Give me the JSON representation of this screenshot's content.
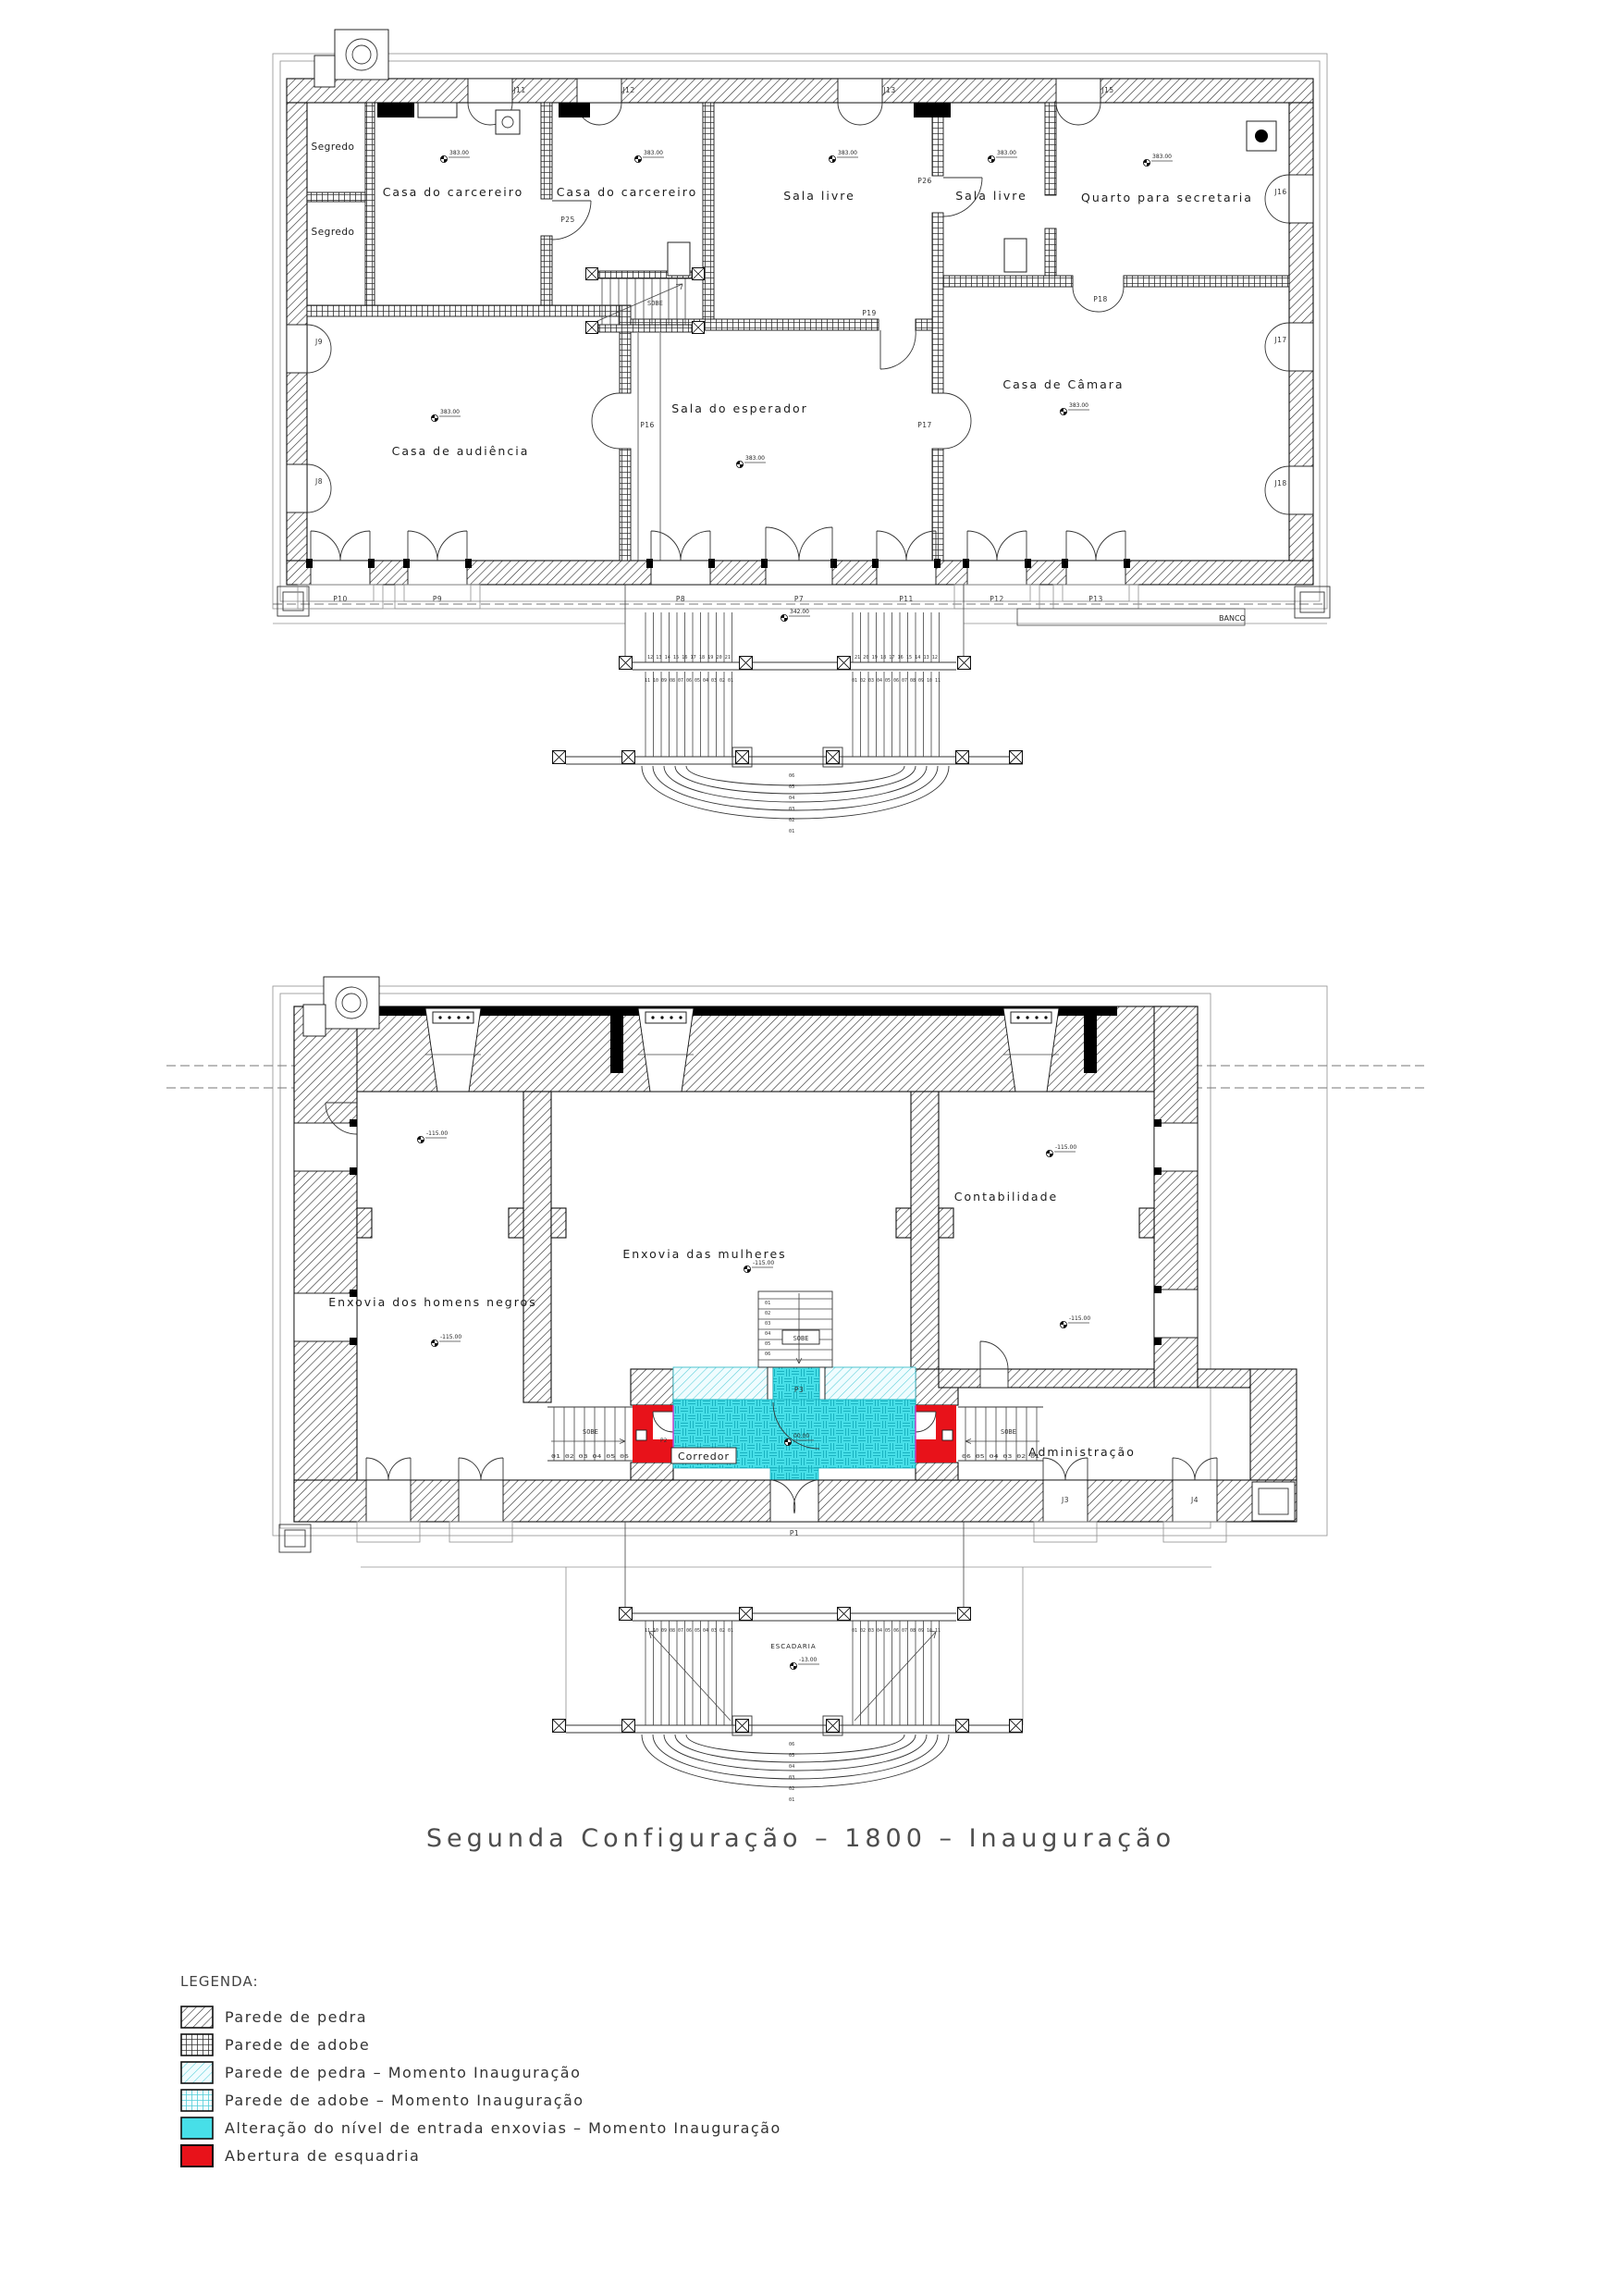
{
  "title": "Segunda Configuração – 1800 – Inauguração",
  "legend": {
    "heading": "LEGENDA:",
    "items": [
      {
        "key": "stone-hatch",
        "label": "Parede de pedra"
      },
      {
        "key": "adobe-grid",
        "label": "Parede de adobe"
      },
      {
        "key": "stone-hatch-cyan",
        "label": "Parede de pedra – Momento Inauguração"
      },
      {
        "key": "adobe-grid-cyan",
        "label": "Parede de adobe – Momento Inauguração"
      },
      {
        "key": "solid-cyan",
        "label": "Alteração do nível de entrada enxovias – Momento Inauguração"
      },
      {
        "key": "solid-red",
        "label": "Abertura de esquadria"
      }
    ]
  },
  "colors": {
    "highlight_cyan": "#47dfe8",
    "highlight_red": "#e8121a"
  },
  "plan1": {
    "rooms": {
      "segredo1": "Segredo",
      "segredo2": "Segredo",
      "carcereiro1": "Casa do carcereiro",
      "carcereiro2": "Casa do carcereiro",
      "sala_livre1": "Sala livre",
      "sala_livre2": "Sala livre",
      "quarto_secretaria": "Quarto para secretaria",
      "sala_esperador": "Sala do esperador",
      "casa_audiencia": "Casa de audiência",
      "casa_camara": "Casa de Câmara"
    },
    "doors": {
      "p7": "P7",
      "p8": "P8",
      "p9": "P9",
      "p10": "P10",
      "p11": "P11",
      "p12": "P12",
      "p13": "P13",
      "p16": "P16",
      "p17": "P17",
      "p18": "P18",
      "p19": "P19",
      "p25": "P25",
      "p26": "P26"
    },
    "windows": {
      "j8": "J8",
      "j9": "J9",
      "j11": "J11",
      "j12": "J12",
      "j13": "J13",
      "j15": "J15",
      "j16": "J16",
      "j17": "J17",
      "j18": "J18"
    },
    "labels": {
      "sobe": "SOBE",
      "banco": "BANCO"
    },
    "levels": {
      "floor": "383.00",
      "terrace": "342.00"
    },
    "stairs": {
      "left_upper": "12 13 14 15 16 17 18 19 20 21",
      "left_lower": "11 10 09 08 07 06 05 04 03 02 01",
      "right_upper": "21 20 19 18 17 16 15 14 13 12",
      "right_lower": "01 02 03 04 05 06 07 08 09 10 11",
      "curved": [
        "06",
        "05",
        "04",
        "03",
        "02",
        "01"
      ]
    }
  },
  "plan2": {
    "rooms": {
      "enxovia_homens": "Enxovia dos homens negros",
      "enxovia_mulheres": "Enxovia das mulheres",
      "contabilidade": "Contabilidade",
      "administracao": "Administração",
      "corredor": "Corredor"
    },
    "doors": {
      "p1": "P1",
      "p2": "P2",
      "p3": "P3"
    },
    "windows": {
      "j3": "J3",
      "j4": "J4"
    },
    "labels": {
      "sobe": "SOBE",
      "escadaria": "ESCADARIA"
    },
    "levels": {
      "rooms": "-115.00",
      "corridor": "00.00",
      "escadaria": "-13.00"
    },
    "stairs": {
      "sobe_left_row": "01 02 03 04 05 06",
      "sobe_right_row": "06 05 04 03 02 01",
      "internal": [
        "01",
        "02",
        "03",
        "04",
        "05",
        "06"
      ],
      "terrace_left": "11 10 09 08 07 06 05 04 03 02 01",
      "terrace_right": "01 02 03 04 05 06 07 08 09 10 11",
      "curved": [
        "06",
        "05",
        "04",
        "03",
        "02",
        "01"
      ]
    }
  }
}
